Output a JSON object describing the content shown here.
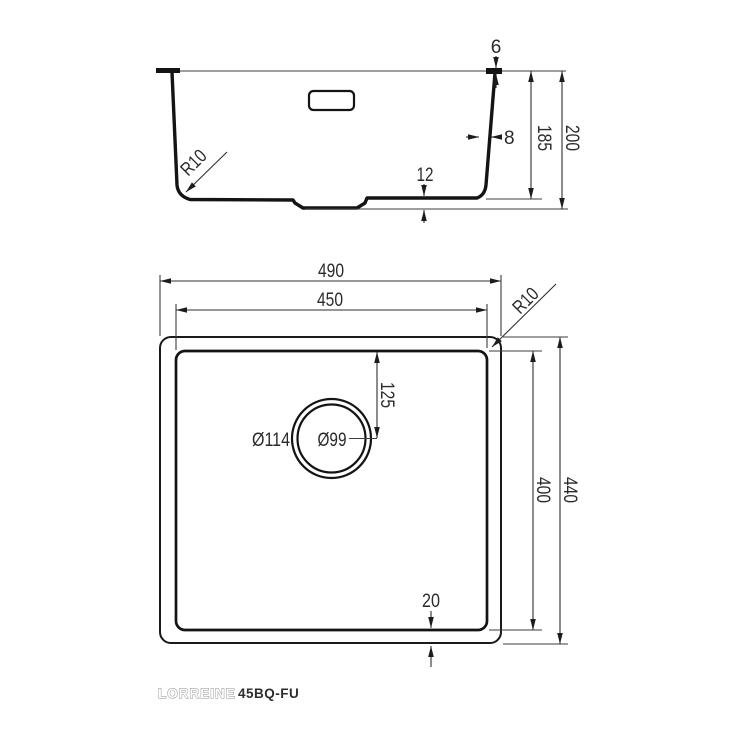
{
  "drawing": {
    "section": {
      "rim_height": "6",
      "wall_thickness": "8",
      "inner_depth": "185",
      "total_height": "200",
      "bottom_thickness": "12",
      "corner_radius": "R10"
    },
    "plan": {
      "outer_width": "490",
      "inner_width": "450",
      "corner_radius": "R10",
      "drain_center_offset": "125",
      "drain_outer_diameter": "Ø114",
      "drain_inner_diameter": "Ø99",
      "inner_length": "400",
      "outer_length": "440",
      "bottom_inset": "20"
    },
    "footer": {
      "brand": "LORREINE",
      "model": "45BQ-FU"
    },
    "colors": {
      "object_line": "#141414",
      "dimension_line": "#2f2f2f",
      "text": "#2b2b2b"
    }
  }
}
